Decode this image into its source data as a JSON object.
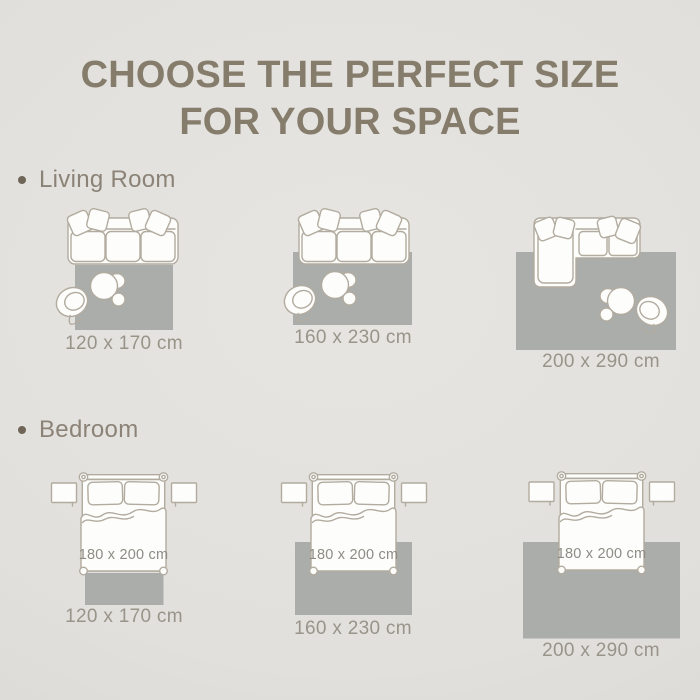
{
  "title": {
    "line1": "CHOOSE THE PERFECT SIZE",
    "line2": "FOR YOUR SPACE"
  },
  "sections": {
    "living": {
      "label": "Living Room",
      "sizes": [
        "120 x 170 cm",
        "160 x 230 cm",
        "200 x 290 cm"
      ]
    },
    "bedroom": {
      "label": "Bedroom",
      "bed_size": "180 x 200 cm",
      "sizes": [
        "120 x 170 cm",
        "160 x 230 cm",
        "200 x 290 cm"
      ]
    }
  },
  "icons": {
    "bullet": "dot-bullet-icon",
    "sofa": "sofa-top-view-icon",
    "sectional_sofa": "l-shaped-sofa-top-view-icon",
    "armchair": "round-armchair-top-view-icon",
    "coffee_table": "coffee-table-top-view-icon",
    "bed": "double-bed-top-view-icon",
    "nightstand": "nightstand-top-view-icon",
    "rug": "rug-swatch"
  },
  "colors": {
    "background": "#e2e0dc",
    "background_edge": "#d8d6d2",
    "title_text": "#857c6b",
    "section_text": "#8b8377",
    "bullet": "#6e6557",
    "caption_text": "#98948a",
    "bed_size_text": "#8e8b85",
    "rug": "#abadaa",
    "furniture_outline": "#b2ab9f",
    "furniture_fill": "#fdfdfb"
  }
}
